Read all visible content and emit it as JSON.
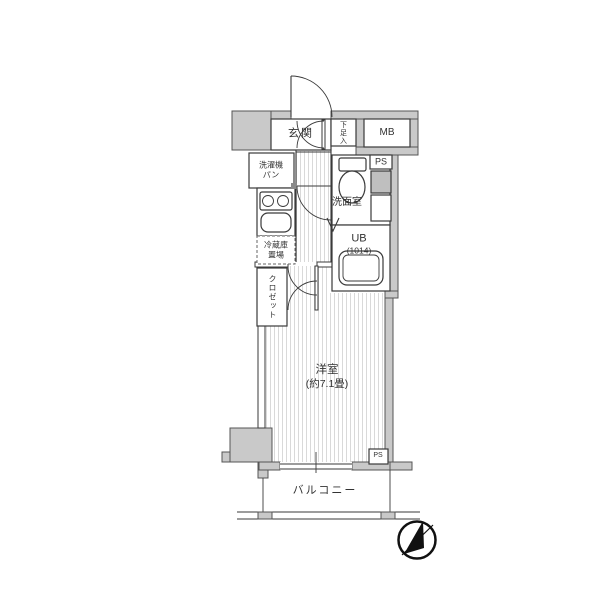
{
  "plan": {
    "labels": {
      "genkan": "玄関",
      "shoe_box": "下足入",
      "meter_box": "MB",
      "pipe_space_top": "PS",
      "washer_pan_line1": "洗濯機",
      "washer_pan_line2": "パン",
      "washroom": "洗面室",
      "unit_bath": "UB",
      "unit_bath_size": "(1014)",
      "fridge_line1": "冷蔵庫",
      "fridge_line2": "置場",
      "closet": "クロゼット",
      "room_name": "洋室",
      "room_size": "(約7.1畳)",
      "balcony": "バルコニー",
      "pipe_space_bottom": "PS"
    },
    "colors": {
      "wall_fill": "#c9c9c9",
      "wall_stroke": "#555555",
      "line": "#3a3a3a",
      "stripe": "#d9d9d9",
      "text": "#333333",
      "background": "#ffffff"
    }
  }
}
